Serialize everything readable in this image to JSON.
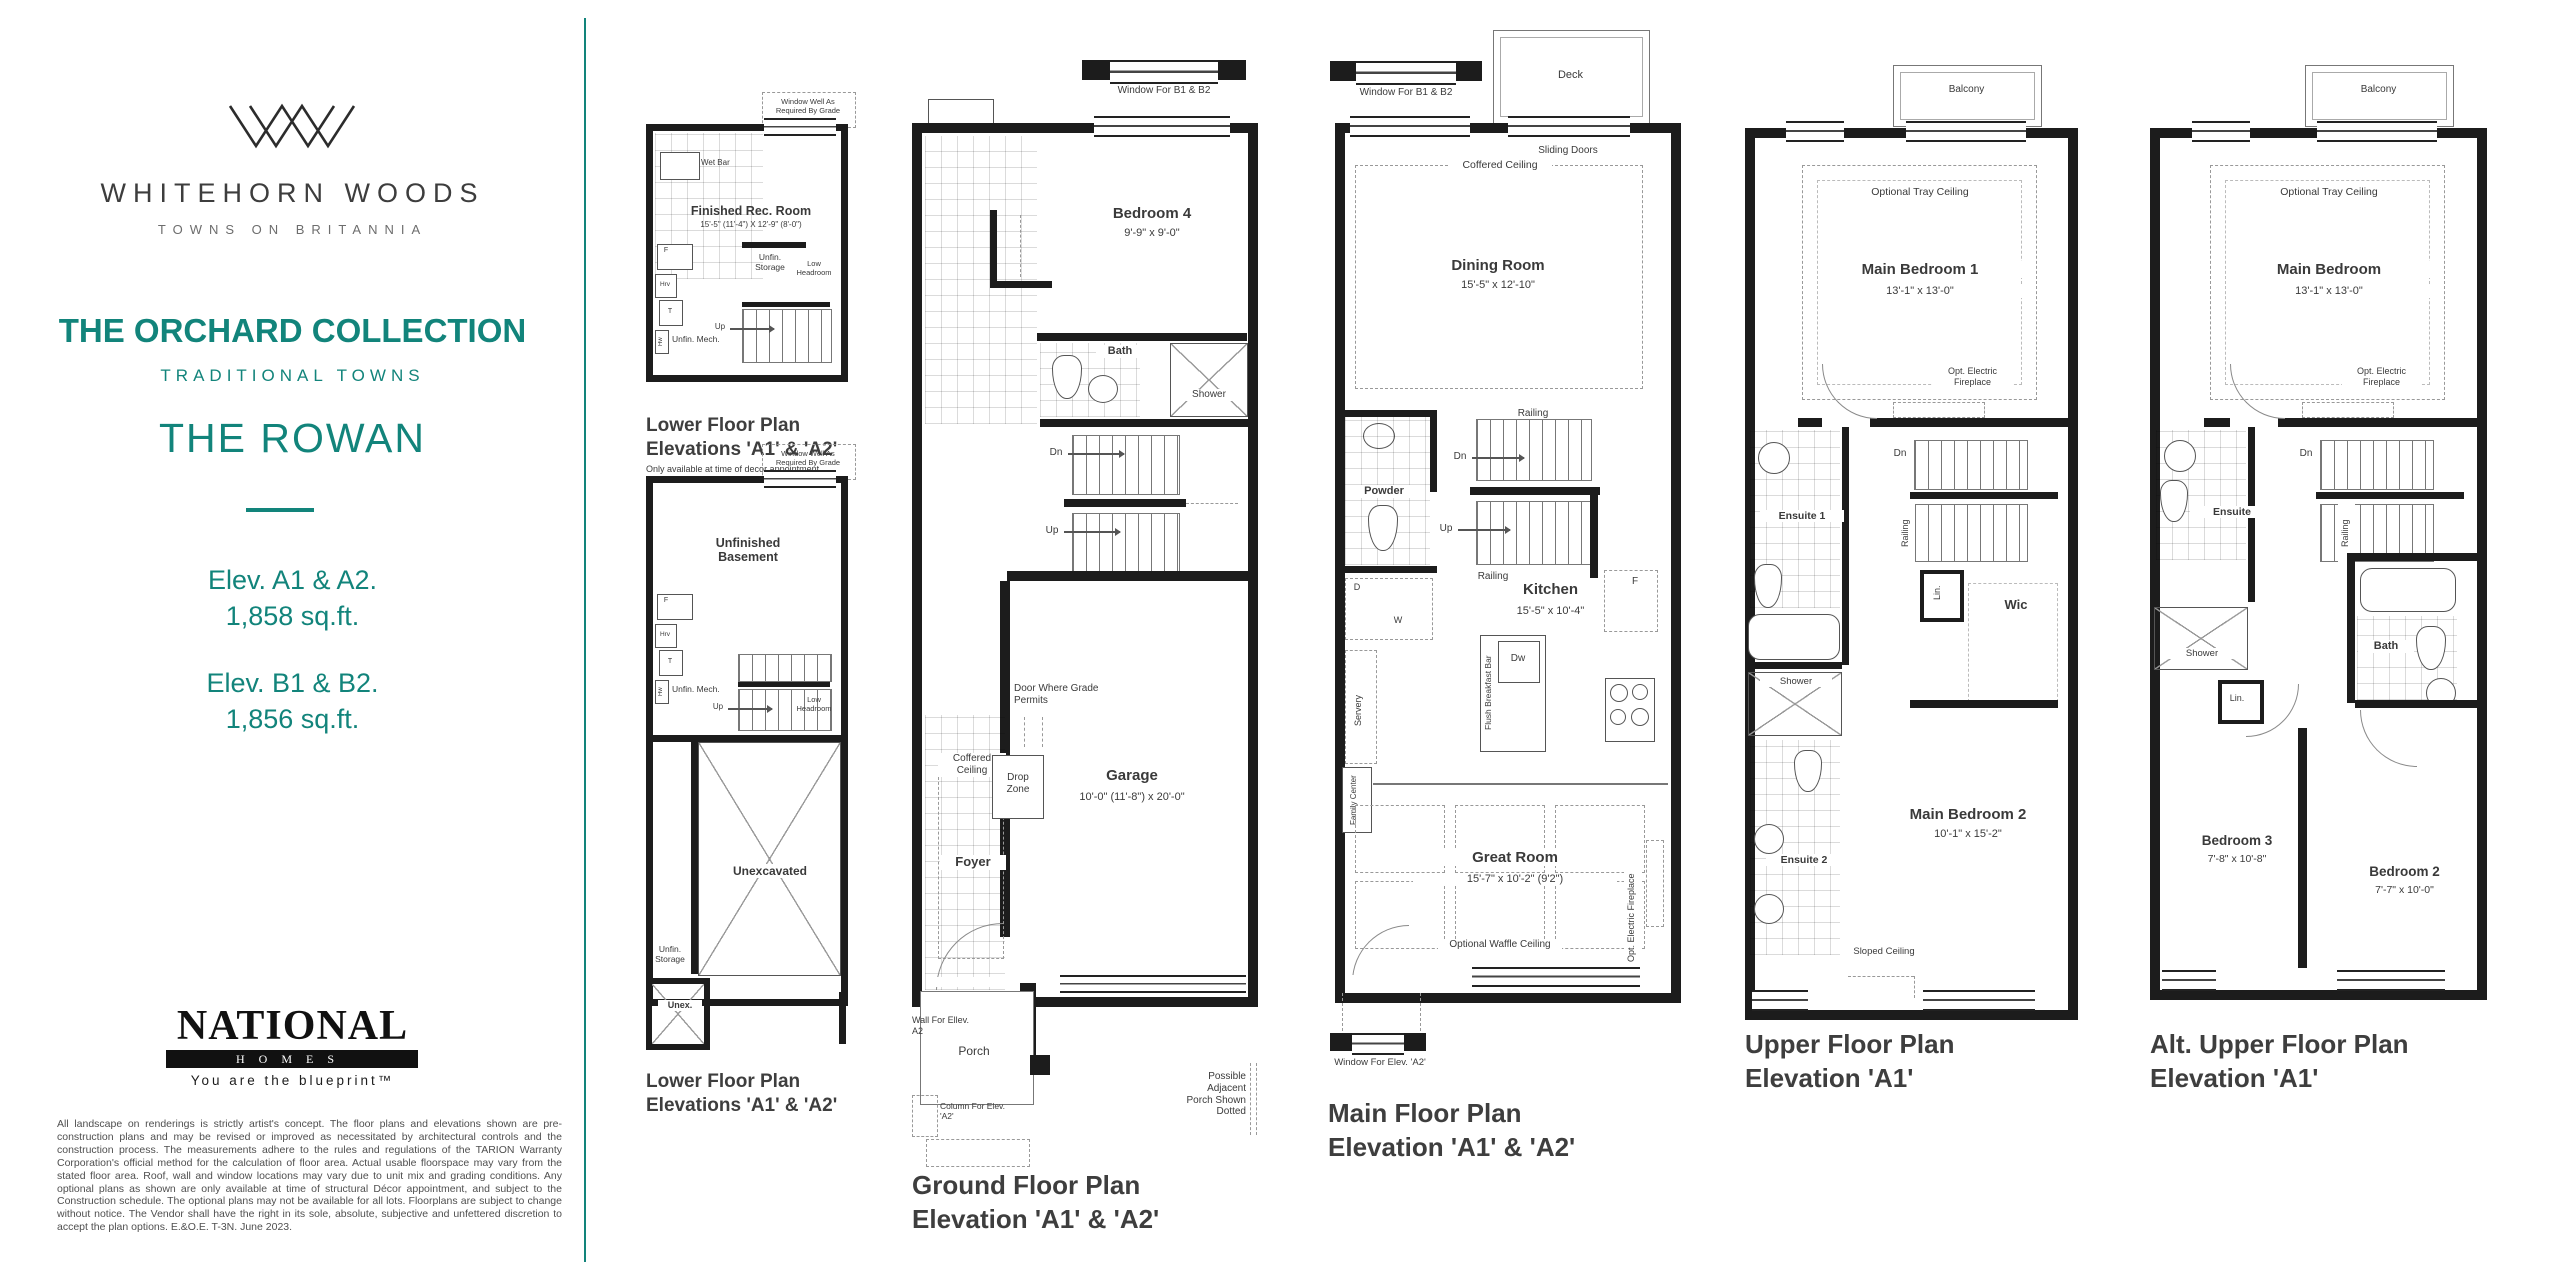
{
  "colors": {
    "accent": "#12847b",
    "wall": "#1c1c1c",
    "ink": "#3a3a3a"
  },
  "sidebar": {
    "brand_name": "WHITEHORN WOODS",
    "brand_tagline": "TOWNS ON BRITANNIA",
    "collection": "THE ORCHARD COLLECTION",
    "series": "TRADITIONAL TOWNS",
    "model": "THE ROWAN",
    "elev_a_label": "Elev. A1 & A2.",
    "elev_a_area": "1,858 sq.ft.",
    "elev_b_label": "Elev. B1 & B2.",
    "elev_b_area": "1,856 sq.ft.",
    "builder_name": "NATIONAL",
    "builder_sub": "HOMES",
    "builder_slogan": "You are the blueprint™",
    "disclaimer": "All landscape on renderings is strictly artist's concept. The floor plans and elevations shown are pre-construction plans and may be revised or improved as necessitated by architectural controls and the construction process. The measurements adhere to the rules and regulations of the TARION Warranty Corporation's official method for the calculation of floor area. Actual usable floorspace may vary from the stated floor area. Roof, wall and window locations may vary due to unit mix and grading conditions. Any optional plans as shown are only available at time of structural Décor appointment, and subject to the Construction schedule.  The optional plans may not be available for all lots.  Floorplans are subject to change without notice.  The Vendor shall have the right in its sole, absolute, subjective and unfettered discretion to accept the plan options.  E.&O.E. T-3N. June 2023."
  },
  "plans": {
    "rec": {
      "window_well": "Window Well As Required By Grade",
      "room_name": "Finished Rec. Room",
      "room_dims": "15'-5\" (11'-4\") X 12'-9\" (8'-0\")",
      "wet_bar": "Wet Bar",
      "f": "F",
      "hrv": "Hrv",
      "t": "T",
      "hw": "Hw",
      "unfin_mech": "Unfin. Mech.",
      "unfin_storage": "Unfin. Storage",
      "low_headroom": "Low Headroom",
      "up": "Up",
      "title1": "Lower Floor Plan",
      "title2": "Elevations 'A1' & 'A2'",
      "note": "Only available at time of decor appointment"
    },
    "basement": {
      "window_well": "Window Well As Required By Grade",
      "room_name": "Unfinished Basement",
      "f": "F",
      "hrv": "Hrv",
      "t": "T",
      "hw": "Hw",
      "unfin_mech": "Unfin. Mech.",
      "up": "Up",
      "low_headroom": "Low Headroom",
      "unexcavated": "Unexcavated",
      "unfin_storage": "Unfin. Storage",
      "unex": "Unex.",
      "title1": "Lower Floor Plan",
      "title2": "Elevations 'A1' & 'A2'"
    },
    "ground": {
      "window_b1b2": "Window For B1 & B2",
      "bedroom4_name": "Bedroom 4",
      "bedroom4_dims": "9'-9\" x 9'-0\"",
      "bath": "Bath",
      "shower": "Shower",
      "dn": "Dn",
      "up": "Up",
      "garage_name": "Garage",
      "garage_dims": "10'-0\" (11'-8\") x 20'-0\"",
      "door_grade": "Door Where Grade Permits",
      "coffered": "Coffered Ceiling",
      "drop_zone": "Drop Zone",
      "foyer": "Foyer",
      "wall_a2": "Wall For Ellev. A2",
      "porch": "Porch",
      "column_a2": "Column For Elev. 'A2'",
      "adjacent": "Possible Adjacent Porch Shown Dotted",
      "title1": "Ground Floor Plan",
      "title2": "Elevation 'A1' & 'A2'"
    },
    "main": {
      "window_b1b2": "Window For B1 & B2",
      "deck": "Deck",
      "sliding": "Sliding Doors",
      "coffered": "Coffered Ceiling",
      "dining_name": "Dining Room",
      "dining_dims": "15'-5\" x 12'-10\"",
      "railing": "Railing",
      "dn": "Dn",
      "up": "Up",
      "powder": "Powder",
      "d": "D",
      "w": "W",
      "kitchen_name": "Kitchen",
      "kitchen_dims": "15'-5\" x 10'-4\"",
      "breakfast_bar": "Flush Breakfast Bar",
      "dw": "Dw",
      "f": "F",
      "servery": "Servery",
      "family_center": "Family Center",
      "great_name": "Great Room",
      "great_dims": "15'-7\" x 10'-2\" (9'2\")",
      "waffle": "Optional Waffle Ceiling",
      "fireplace": "Opt. Electric Fireplace",
      "window_a2": "Window For Elev. 'A2'",
      "title1": "Main Floor Plan",
      "title2": "Elevation 'A1' & 'A2'"
    },
    "upper": {
      "balcony": "Balcony",
      "tray": "Optional Tray Ceiling",
      "bed1_name": "Main Bedroom 1",
      "bed1_dims": "13'-1\" x 13'-0\"",
      "fireplace": "Opt. Electric Fireplace",
      "ensuite1": "Ensuite 1",
      "dn": "Dn",
      "railing": "Railing",
      "lin": "Lin.",
      "wic": "Wic",
      "shower": "Shower",
      "ensuite2": "Ensuite 2",
      "bed2_name": "Main Bedroom 2",
      "bed2_dims": "10'-1\" x 15'-2\"",
      "sloped": "Sloped Ceiling",
      "title1": "Upper Floor Plan",
      "title2": "Elevation 'A1'"
    },
    "alt": {
      "balcony": "Balcony",
      "tray": "Optional Tray Ceiling",
      "bed_name": "Main Bedroom",
      "bed_dims": "13'-1\" x 13'-0\"",
      "fireplace": "Opt. Electric Fireplace",
      "ensuite": "Ensuite",
      "dn": "Dn",
      "railing": "Railing",
      "shower": "Shower",
      "lin": "Lin.",
      "bath": "Bath",
      "bed3_name": "Bedroom 3",
      "bed3_dims": "7'-8\" x 10'-8\"",
      "bed2_name": "Bedroom 2",
      "bed2_dims": "7'-7\" x 10'-0\"",
      "title1": "Alt. Upper Floor Plan",
      "title2": "Elevation 'A1'"
    }
  }
}
